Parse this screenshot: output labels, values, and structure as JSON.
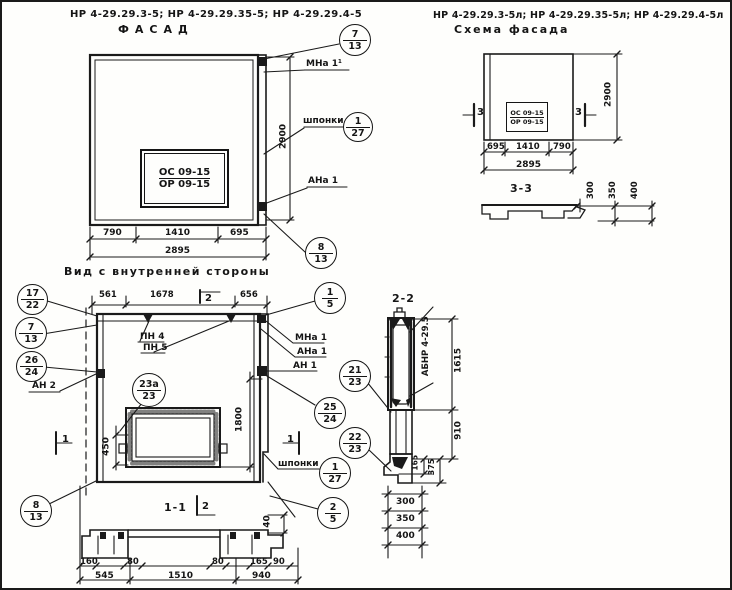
{
  "facade": {
    "codes": "НР 4-29.29.3-5; НР 4-29.29.35-5; НР 4-29.29.4-5",
    "title": "ФАСАД",
    "stamp_line1": "ОС 09-15",
    "stamp_line2": "ОР 09-15",
    "dims_bottom": [
      "790",
      "1410",
      "695"
    ],
    "dim_total": "2895",
    "dim_height": "2900",
    "label_mna": "МНа 1¹",
    "label_shponki": "шпонки",
    "label_ana": "АНа 1",
    "callouts": {
      "c7_13": {
        "t": "7",
        "b": "13"
      },
      "c1_27": {
        "t": "1",
        "b": "27"
      },
      "c8_13": {
        "t": "8",
        "b": "13"
      }
    }
  },
  "schema": {
    "codes": "НР 4-29.29.3-5л; НР 4-29.29.35-5л; НР 4-29.29.4-5л",
    "title": "Схема фасада",
    "stamp_line1": "ОС 09-15",
    "stamp_line2": "ОР 09-15",
    "dims_bottom": [
      "695",
      "1410",
      "790"
    ],
    "dim_total": "2895",
    "dim_height": "2900",
    "section_mark": "3",
    "section_title": "3-3",
    "profile_dims": [
      "300",
      "350",
      "400"
    ]
  },
  "inner": {
    "title": "Вид с внутренней стороны",
    "dims_top": [
      "561",
      "1678",
      "656"
    ],
    "dim_450": "450",
    "dim_1800": "1800",
    "dim_40": "40",
    "pn4": "ПН 4",
    "pn5": "ПН 5",
    "mna1": "МНа 1",
    "ana1": "АНа 1",
    "an1": "АН 1",
    "an2": "АН 2",
    "shponki": "шпонки",
    "mark1": "1",
    "mark2": "2",
    "callouts": {
      "c17_22": {
        "t": "17",
        "b": "22"
      },
      "c7_13": {
        "t": "7",
        "b": "13"
      },
      "c26_24": {
        "t": "26",
        "b": "24"
      },
      "c8_13": {
        "t": "8",
        "b": "13"
      },
      "c1_5": {
        "t": "1",
        "b": "5"
      },
      "c25_24": {
        "t": "25",
        "b": "24"
      },
      "c21_23": {
        "t": "21",
        "b": "23"
      },
      "c22_23": {
        "t": "22",
        "b": "23"
      },
      "c1_27": {
        "t": "1",
        "b": "27"
      },
      "c2_5": {
        "t": "2",
        "b": "5"
      },
      "c23a_23": {
        "t": "23а",
        "b": "23"
      }
    }
  },
  "section11": {
    "title": "1-1",
    "dims_row1": [
      "160",
      "80",
      "80",
      "165",
      "90"
    ],
    "dims_row2": [
      "545",
      "1510",
      "940"
    ]
  },
  "section22": {
    "title": "2-2",
    "part_label": "АБНР 4-29.5",
    "dim_1615": "1615",
    "dim_910": "910",
    "dim_165": "165",
    "dim_375": "375",
    "dims_bottom": [
      "300",
      "350",
      "400"
    ]
  }
}
